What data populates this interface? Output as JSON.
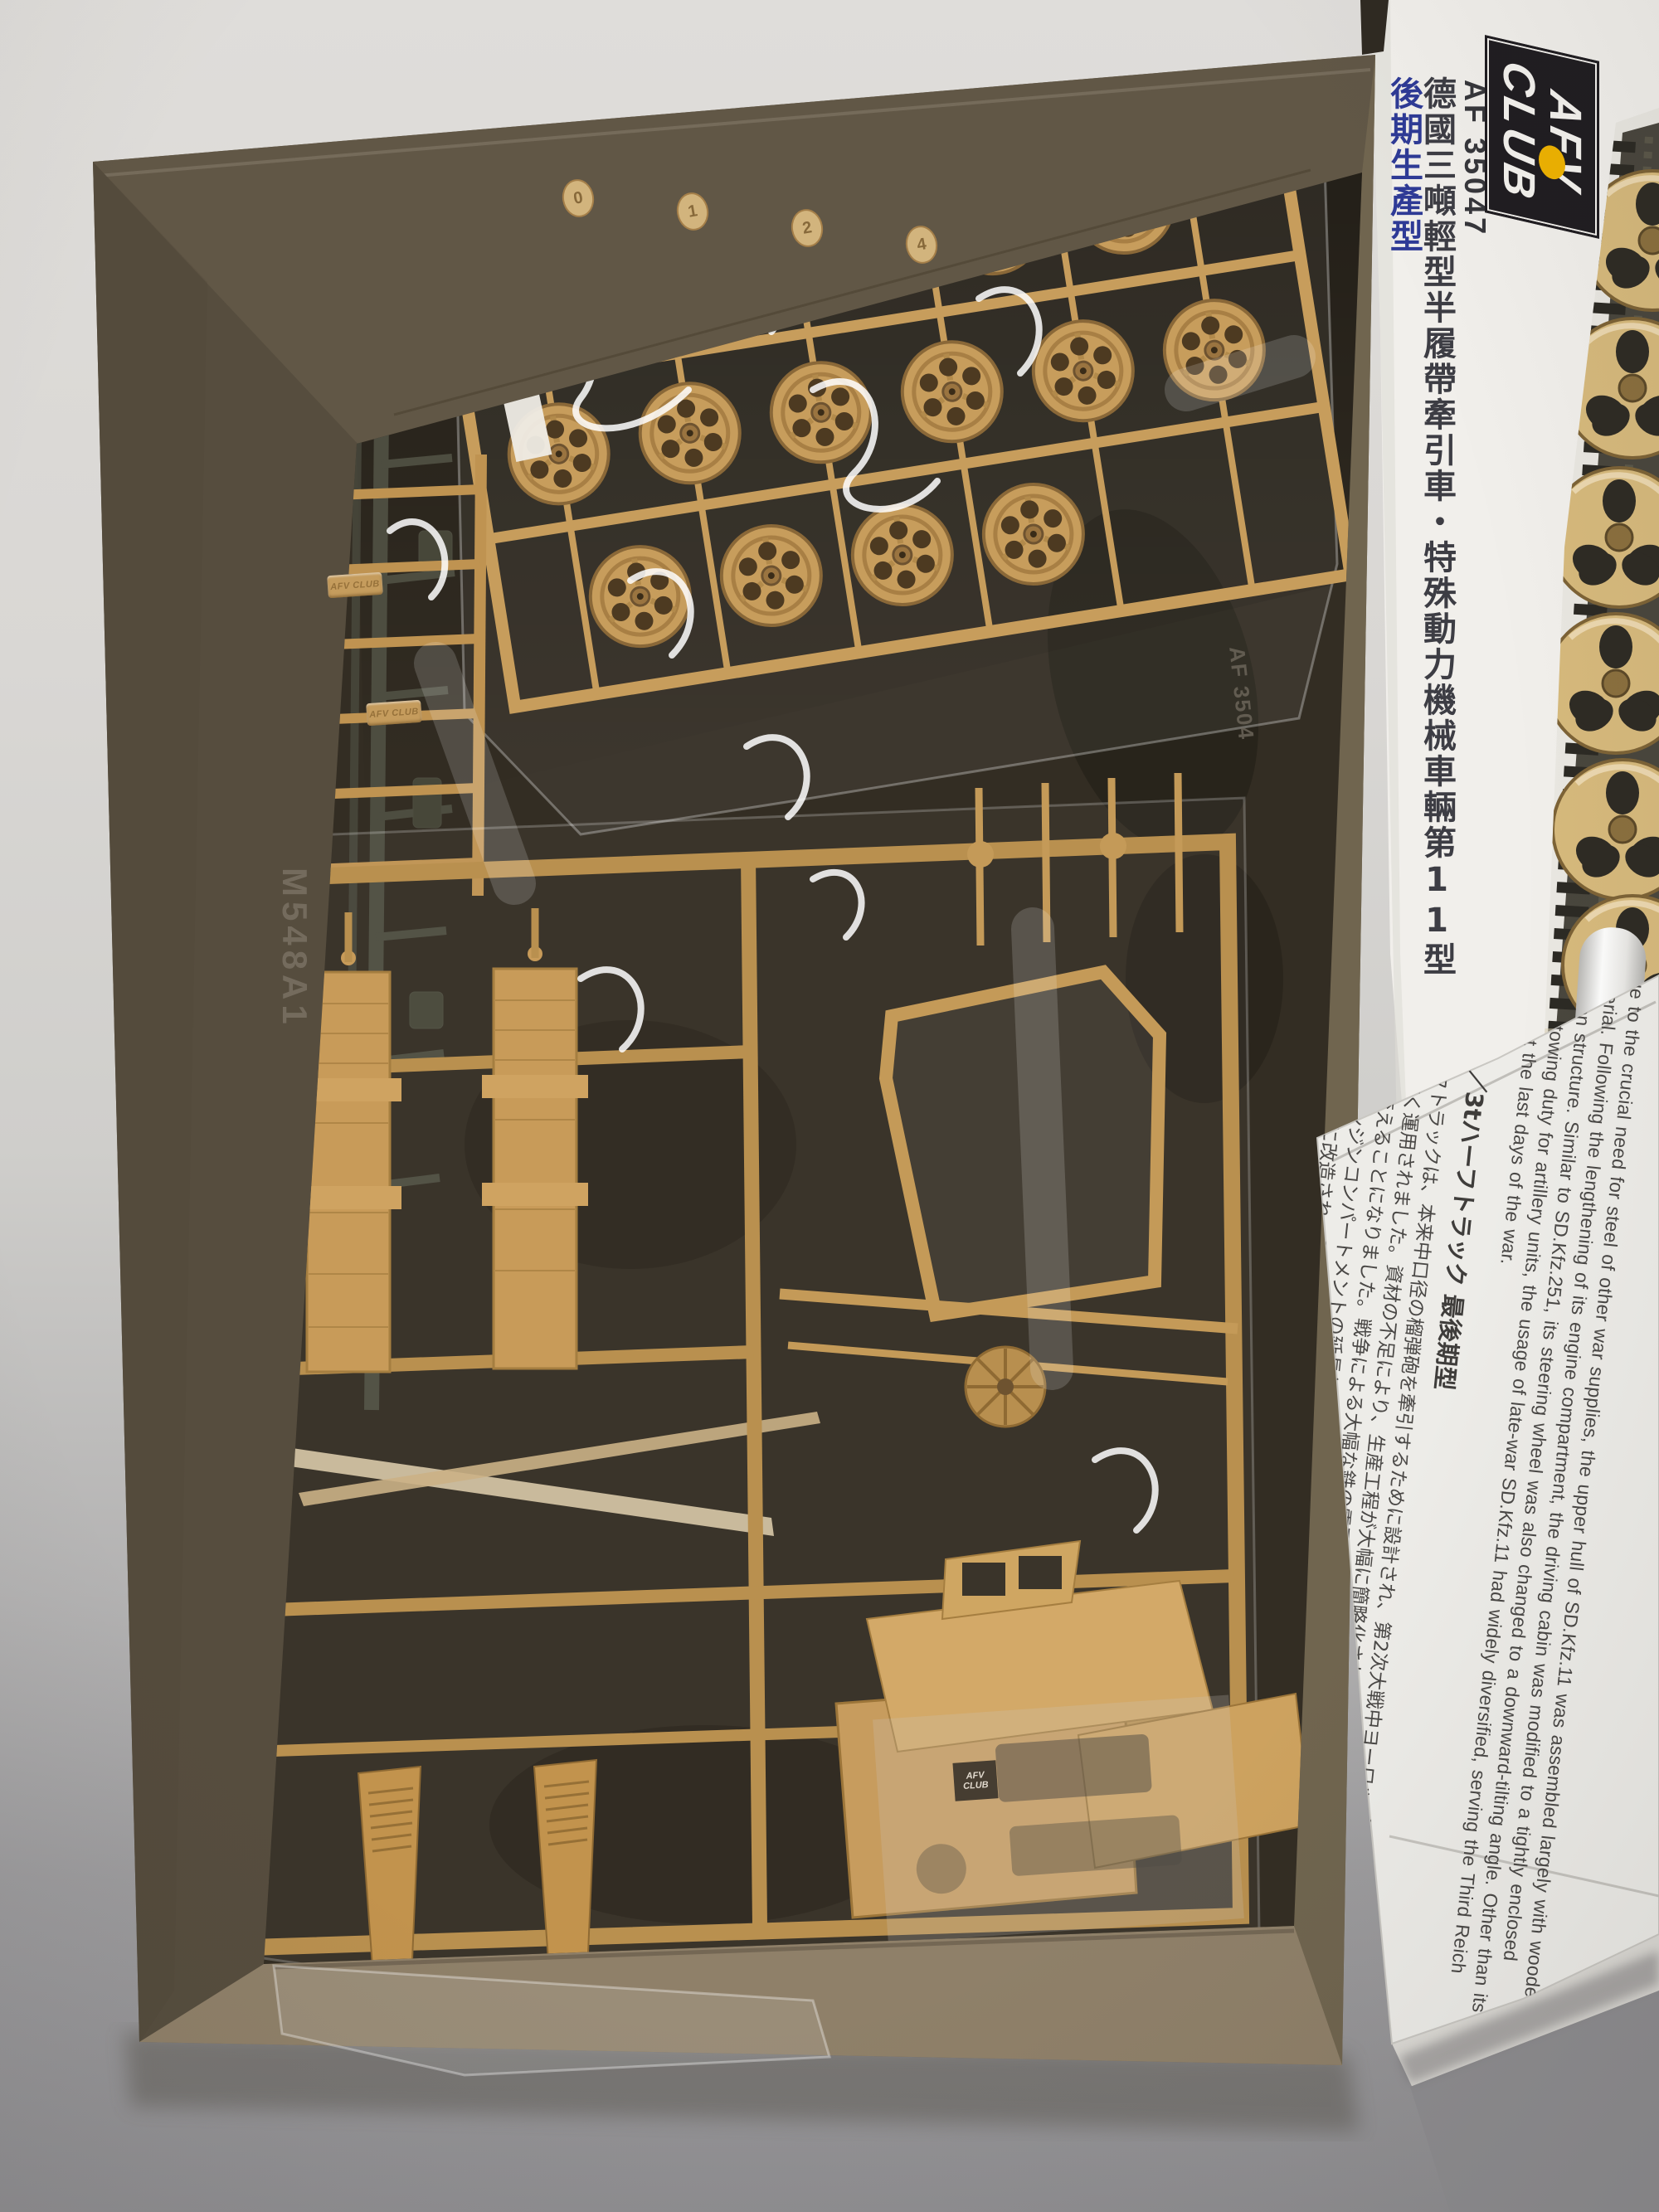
{
  "photo": {
    "description": "Opened AFV Club model kit box showing bagged tan plastic sprues, white box side panel with brand logo and kit number, box-art edge, and folded instruction sheet",
    "box_panel": {
      "brand_line1": "AFV",
      "brand_line2": "CLUB",
      "product_code": "AF 35047",
      "title_cn_main": "德國三噸輕型半履帶牽引車・特殊動力機械車輛第11型",
      "title_cn_sub": "後期生產型",
      "accent_blue": "#2e3a96",
      "logo_yellow": "#efb301",
      "logo_black": "#201d21"
    },
    "sprues": {
      "molded_tag": "AFV CLUB",
      "bag_print_code": "AF 3504",
      "bag_emboss": "M548A1",
      "runner_tag_numbers": [
        "0",
        "1",
        "2",
        "4"
      ],
      "plastic_tan": "#c79d5c",
      "plastic_dark_green": "#4b4b3f",
      "cardboard_kraft": "#6d6250"
    },
    "instructions": {
      "paragraph_en": "Due to the crucial need for steel of other war supplies, the upper hull of SD.Kfz.11 was assembled largely with wooden material. Following the lengthening of its engine compartment, the driving cabin was modified to a tightly enclosed wooden structure. Similar to SD.Kfz.251, its steering wheel was also changed to a downward-tilting angle. Other than its original towing duty for artillery units, the usage of late-war SD.Kfz.11 had widely diversified, serving the Third Reich throughout the last days of the war.",
      "heading_jp": "Sd.Kfz11／3tハーフトラック 最後期型",
      "paragraph_jp": "Sd.Kfz.11ハーフトラックは、本来中口径の榴弾砲を牽引するために設計され、第2次大戦中ヨーロッパから北アフリカに至るあらゆる戦線で広く運用されました。資材の不足により、生産工程が大幅に簡略化されることとなり、との部品共通化が図られ、大きく外観を変えることになりました。戦争による大幅な鉄の需要増により、後期型Sd.Kfz.11は、上部構造の大部分が木製で製造され、エンジンコンパートメントの延長とともに、運転席は密閉式の木製キャビンタイプに変更されました。ハンドルは下方に向く角度に改造され、Sd.Kfz.251と同様、その牽引用途のみならず、大戦末期のドイツ軍により幅広く利用されました。",
      "mini_logo_line1": "AFV",
      "mini_logo_line2": "CLUB"
    }
  }
}
